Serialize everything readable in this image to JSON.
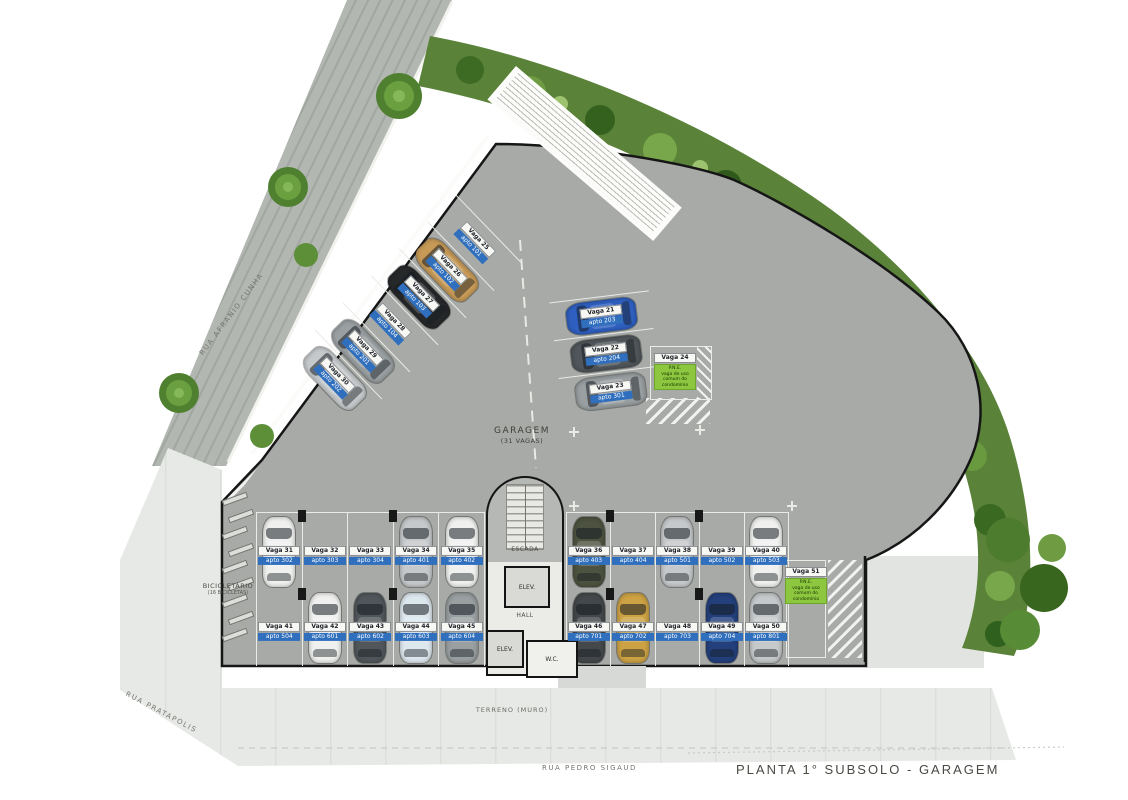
{
  "title": "PLANTA 1° SUBSOLO - GARAGEM",
  "streets": {
    "left": "RUA AFRANIO CUNHA",
    "bottom": "RUA PEDRO SIGAUD",
    "corner": "RUA PRATAPOLIS"
  },
  "labels": {
    "garage": "GARAGEM",
    "garage_capacity": "(31 VAGAS)",
    "terreno": "TERRENO (MURO)",
    "bike": "BICICLETÁRIO",
    "bike_capacity": "(16 BICICLETAS)",
    "stairs": "ESCADA",
    "elevator1": "ELEV.",
    "elevator2": "ELEV.",
    "hall": "HALL",
    "wc": "W.C.",
    "vaga_prefix": "Vaga",
    "apto_prefix": "apto"
  },
  "pne": {
    "upper_header": "Vaga 24",
    "lower_header": "Vaga 51",
    "note": [
      "P.N.E.",
      "vaga de uso",
      "comum do condomínio"
    ]
  },
  "colors": {
    "tag_blue": "#2f6fbd",
    "pne_green": "#8dc63f",
    "slab": "#a7aaa6",
    "green_band": "#5a8238",
    "car": {
      "white": "#f0f1ef",
      "silver": "#c6c9cb",
      "gray": "#9aa0a2",
      "dark": "#50565a",
      "darkgray": "#44484b",
      "black": "#26282a",
      "navy": "#23407c",
      "blue": "#2f5fc0",
      "lightblue": "#dde8ee",
      "tan": "#c79a57",
      "gold": "#cda244",
      "olive": "#4d5340"
    }
  },
  "parking": {
    "angled": [
      {
        "vaga": "25",
        "apto": "101",
        "car": null
      },
      {
        "vaga": "26",
        "apto": "102",
        "car": "tan"
      },
      {
        "vaga": "27",
        "apto": "103",
        "car": "black"
      },
      {
        "vaga": "28",
        "apto": "104",
        "car": null
      },
      {
        "vaga": "29",
        "apto": "201",
        "car": "gray"
      },
      {
        "vaga": "30",
        "apto": "202",
        "car": "silver"
      }
    ],
    "trio": [
      {
        "vaga": "21",
        "apto": "203",
        "car": "blue"
      },
      {
        "vaga": "22",
        "apto": "204",
        "car": "dark"
      },
      {
        "vaga": "23",
        "apto": "301",
        "car": "gray"
      }
    ],
    "left_top": [
      {
        "vaga": "31",
        "apto": "302",
        "car": "white"
      },
      {
        "vaga": "32",
        "apto": "303",
        "car": null
      },
      {
        "vaga": "33",
        "apto": "304",
        "car": null
      },
      {
        "vaga": "34",
        "apto": "401",
        "car": "silver"
      },
      {
        "vaga": "35",
        "apto": "402",
        "car": "white"
      }
    ],
    "right_top": [
      {
        "vaga": "36",
        "apto": "403",
        "car": "olive"
      },
      {
        "vaga": "37",
        "apto": "404",
        "car": null
      },
      {
        "vaga": "38",
        "apto": "501",
        "car": "silver"
      },
      {
        "vaga": "39",
        "apto": "502",
        "car": null
      },
      {
        "vaga": "40",
        "apto": "503",
        "car": "white"
      }
    ],
    "left_bottom": [
      {
        "vaga": "41",
        "apto": "504",
        "car": null
      },
      {
        "vaga": "42",
        "apto": "601",
        "car": "white"
      },
      {
        "vaga": "43",
        "apto": "602",
        "car": "dark"
      },
      {
        "vaga": "44",
        "apto": "603",
        "car": "lightblue"
      },
      {
        "vaga": "45",
        "apto": "604",
        "car": "gray"
      }
    ],
    "right_bottom": [
      {
        "vaga": "46",
        "apto": "701",
        "car": "darkgray"
      },
      {
        "vaga": "47",
        "apto": "702",
        "car": "gold"
      },
      {
        "vaga": "48",
        "apto": "703",
        "car": null
      },
      {
        "vaga": "49",
        "apto": "704",
        "car": "navy"
      },
      {
        "vaga": "50",
        "apto": "801",
        "car": "silver"
      }
    ]
  }
}
